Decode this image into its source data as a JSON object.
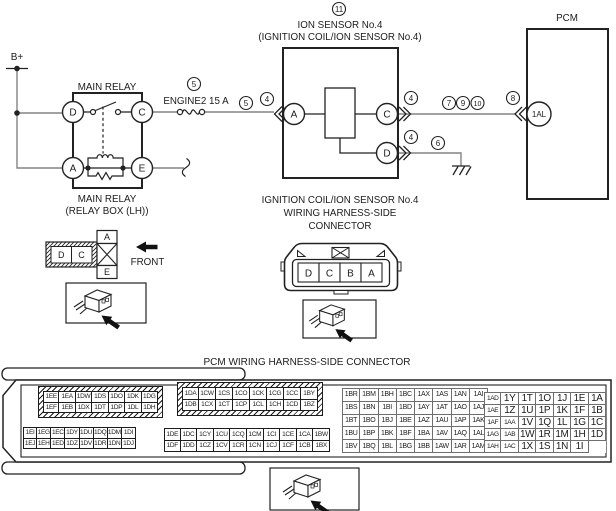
{
  "colors": {
    "line": "#222222",
    "wire": "#848484"
  },
  "diagram": {
    "labels": {
      "bplus": "B+",
      "main_relay_title": "MAIN RELAY",
      "main_relay_caption_1": "MAIN RELAY",
      "main_relay_caption_2": "(RELAY BOX (LH))",
      "fuse_name": "ENGINE2 15 A",
      "ion_title_1": "ION SENSOR No.4",
      "ion_title_2": "(IGNITION COIL/ION SENSOR No.4)",
      "pcm_title": "PCM",
      "coil_conn_caption_1": "IGNITION COIL/ION SENSOR No.4",
      "coil_conn_caption_2": "WIRING HARNESS-SIDE",
      "coil_conn_caption_3": "CONNECTOR",
      "front": "FRONT"
    },
    "callouts": {
      "ion": "11",
      "fuse": "5",
      "inline5": "5",
      "inline4": "4",
      "c4": "4",
      "c7": "7",
      "c9": "9",
      "c10": "10",
      "c8": "8",
      "d4": "4",
      "d6": "6"
    },
    "terminals": {
      "relay": [
        "D",
        "C",
        "A",
        "E"
      ],
      "ion": [
        "A",
        "C",
        "D"
      ],
      "pcm": "1AL"
    }
  },
  "relay_connector": {
    "cells": [
      "D",
      "C"
    ],
    "stack": [
      "A",
      "E"
    ]
  },
  "coil_connector": {
    "cells": [
      "D",
      "C",
      "B",
      "A"
    ]
  },
  "pcm_connector": {
    "title": "PCM WIRING HARNESS-SIDE CONNECTOR",
    "blocks": [
      {
        "id": "left-top",
        "hatched": true,
        "rows": [
          [
            "1EE",
            "1EA",
            "1DW",
            "1DS",
            "1DO",
            "1DK",
            "1DG"
          ],
          [
            "1EF",
            "1EB",
            "1DX",
            "1DT",
            "1DP",
            "1DL",
            "1DH"
          ]
        ]
      },
      {
        "id": "left-bottom",
        "hatched": false,
        "rows": [
          [
            "1EI",
            "1EG",
            "1EC",
            "1DY",
            "1DU",
            "1DQ",
            "1DM",
            "1DI"
          ],
          [
            "1EJ",
            "1EH",
            "1ED",
            "1DZ",
            "1DV",
            "1DR",
            "1DN",
            "1DJ"
          ]
        ]
      },
      {
        "id": "mid-top",
        "hatched": true,
        "rows": [
          [
            "1DA",
            "1CW",
            "1CS",
            "1CO",
            "1CK",
            "1CG",
            "1CC",
            "1BY"
          ],
          [
            "1DB",
            "1CX",
            "1CT",
            "1CP",
            "1CL",
            "1CH",
            "1CD",
            "1BZ"
          ]
        ]
      },
      {
        "id": "mid-bottom",
        "hatched": false,
        "rows": [
          [
            "1DE",
            "1DC",
            "1CY",
            "1CU",
            "1CQ",
            "1CM",
            "1CI",
            "1CE",
            "1CA",
            "1BW"
          ],
          [
            "1DF",
            "1DD",
            "1CZ",
            "1CV",
            "1CR",
            "1CN",
            "1CJ",
            "1CF",
            "1CB",
            "1BX"
          ]
        ]
      },
      {
        "id": "right-a",
        "hatched": false,
        "rows": [
          [
            "1BR",
            "1BM",
            "1BH",
            "1BC",
            "1AX",
            "1AS",
            "1AN",
            "1AI"
          ],
          [
            "1BS",
            "1BN",
            "1BI",
            "1BD",
            "1AY",
            "1AT",
            "1AO",
            "1AJ"
          ],
          [
            "1BT",
            "1BO",
            "1BJ",
            "1BE",
            "1AZ",
            "1AU",
            "1AP",
            "1AK"
          ],
          [
            "1BU",
            "1BP",
            "1BK",
            "1BF",
            "1BA",
            "1AV",
            "1AQ",
            "1AL"
          ],
          [
            "1BV",
            "1BQ",
            "1BL",
            "1BG",
            "1BB",
            "1AW",
            "1AR",
            "1AM"
          ]
        ]
      },
      {
        "id": "right-b",
        "hatched": false,
        "rows": [
          [
            "1AD",
            "1Y",
            "1T",
            "1O",
            "1J",
            "1E",
            "1A"
          ],
          [
            "1AE",
            "1Z",
            "1U",
            "1P",
            "1K",
            "1F",
            "1B"
          ],
          [
            "1AF",
            "1AA",
            "1V",
            "1Q",
            "1L",
            "1G",
            "1C"
          ],
          [
            "1AG",
            "1AB",
            "1W",
            "1R",
            "1M",
            "1H",
            "1D"
          ],
          [
            "1AH",
            "1AC",
            "1X",
            "1S",
            "1N",
            "1I",
            ""
          ]
        ]
      }
    ]
  }
}
